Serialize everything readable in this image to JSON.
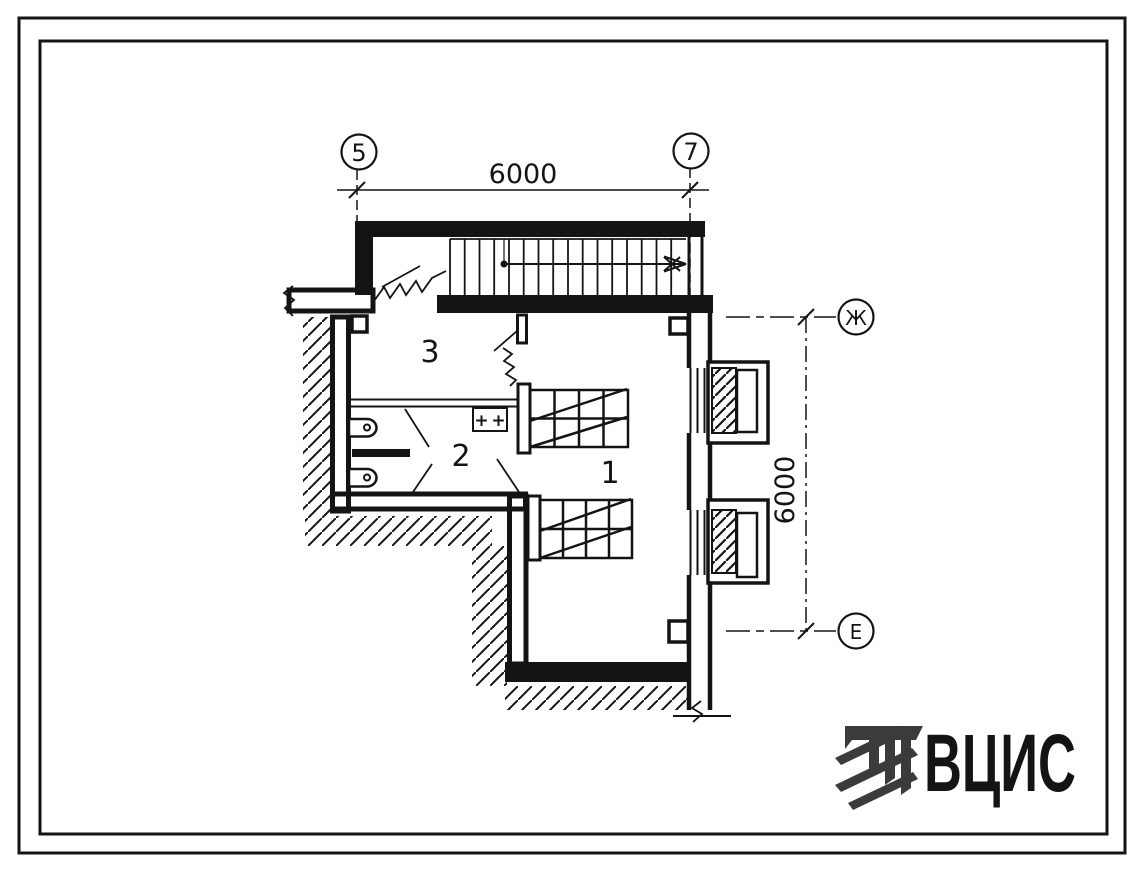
{
  "drawing": {
    "axis_markers": {
      "top_left": "5",
      "top_right": "7",
      "right_top": "Ж",
      "right_bottom": "Е"
    },
    "dimensions": {
      "top": "6000",
      "right": "6000"
    },
    "room_labels": {
      "room1": "1",
      "room2": "2",
      "room3": "3"
    },
    "equipment_box": {
      "plus_left": "+",
      "plus_right": "+"
    }
  },
  "logo": {
    "text": "ВЦИС"
  },
  "colors": {
    "ink": "#141414",
    "logo": "#3b3b3e",
    "paper": "#ffffff"
  }
}
